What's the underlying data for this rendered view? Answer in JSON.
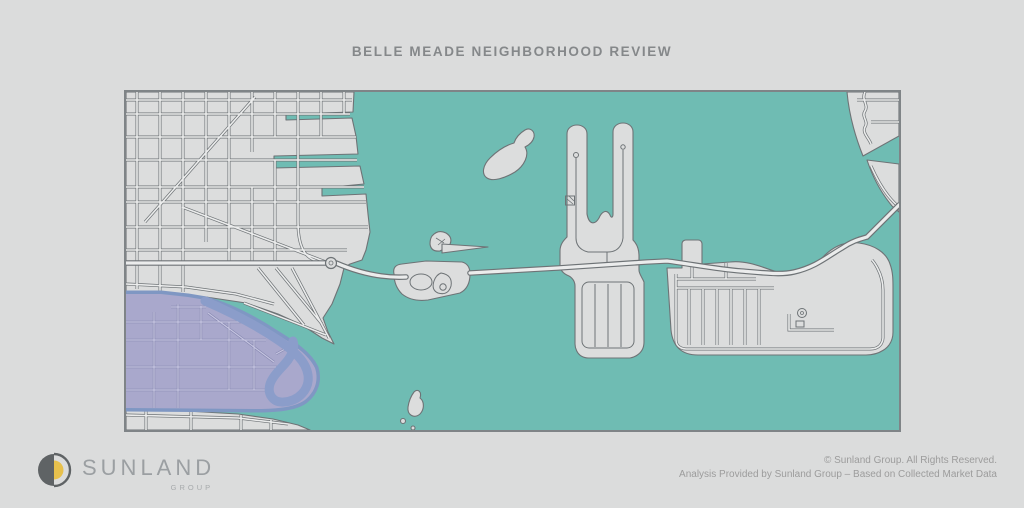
{
  "page": {
    "background_color": "#dbdcdc"
  },
  "header": {
    "title": "BELLE MEADE NEIGHBORHOOD REVIEW"
  },
  "map": {
    "colors": {
      "water": "#6fbcb3",
      "land": "#dcdddd",
      "street": "#ebecec",
      "outline": "#6e7376",
      "border": "#7f8487",
      "highlight": "#a9a8cc",
      "highlight_water": "#8b9dca",
      "highlight_rim": "#7f97c3",
      "highlight_street": "#8587b0",
      "highlight_street_fill": "#c5c4e0"
    }
  },
  "logo": {
    "brand": "SUNLAND",
    "suffix": "GROUP",
    "accent_color": "#e7c04c",
    "mark_color": "#5f6365",
    "text_color": "#9b9fa2"
  },
  "footer": {
    "line1": "© Sunland Group. All Rights Reserved.",
    "line2": "Analysis Provided by Sunland Group – Based on Collected Market Data"
  }
}
